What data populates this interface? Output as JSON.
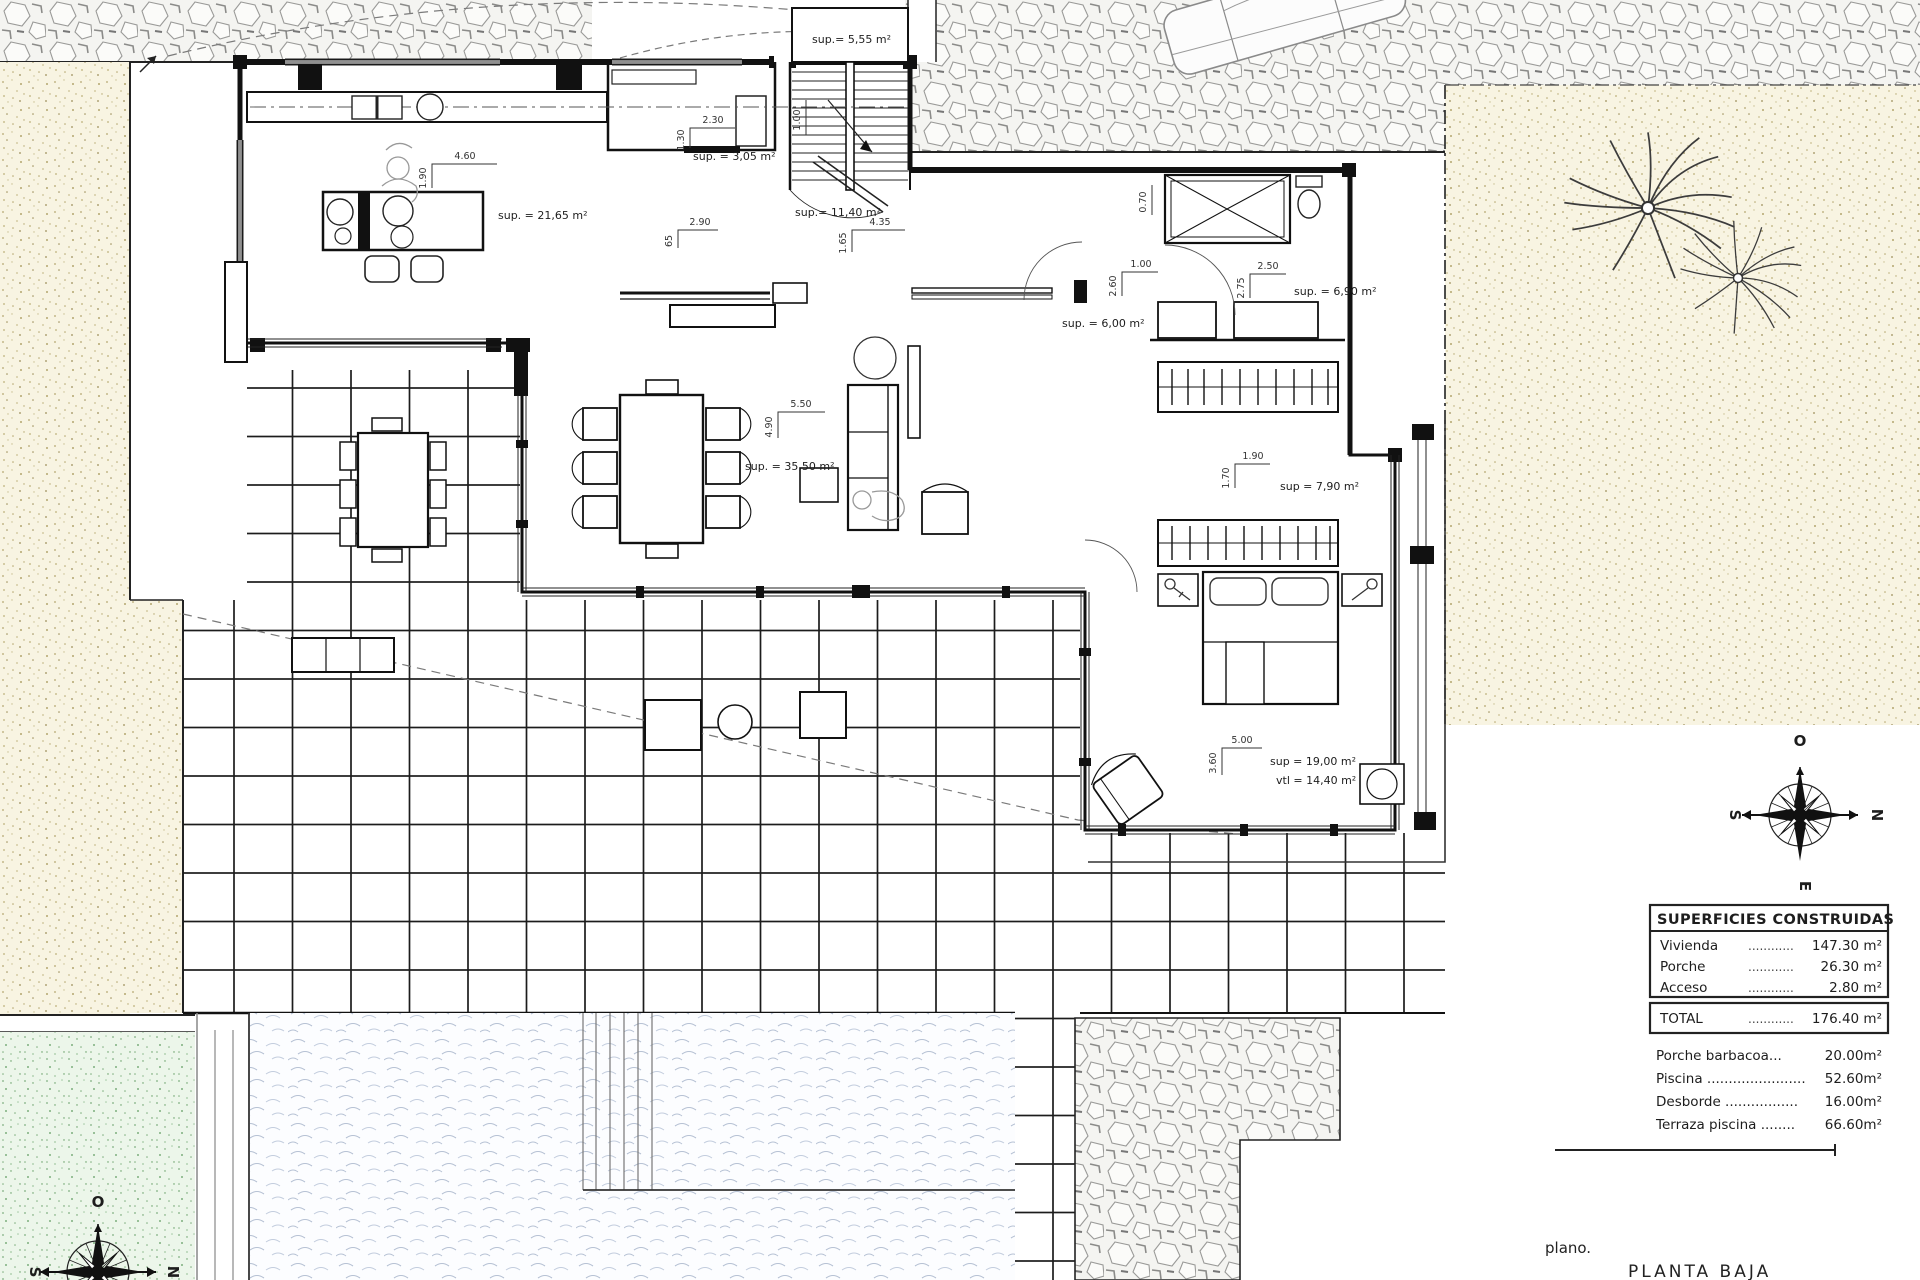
{
  "titles": {
    "plan_label": "plano.",
    "plan_title": "PLANTA BAJA"
  },
  "compass": {
    "top": "O",
    "right": "N",
    "left": "S",
    "bottom": "E"
  },
  "rooms": {
    "stairs": "sup.= 5,55 m²",
    "pantry": "sup. = 3,05 m²",
    "hall": "sup.= 11,40 m²",
    "kitchen": "sup. = 21,65 m²",
    "living": "sup. = 35,50 m²",
    "corridor": "sup. = 6,00 m²",
    "bath": "sup. = 6,90 m²",
    "dressing": "sup = 7,90 m²",
    "bedroom": "sup = 19,00 m²",
    "bedroom_vtl": "vtl = 14,40 m²"
  },
  "dims": {
    "kitchen_w": "4.60",
    "kitchen_h": "1.90",
    "pantry_w": "2.30",
    "pantry_h": "1.30",
    "sideboard_w": "2.90",
    "sideboard_h": "65",
    "hall_w": "4.35",
    "hall_h": "1.65",
    "living_w": "5.50",
    "living_h": "4.90",
    "stair_run": "1.00",
    "corridor_w": "1.00",
    "corridor_h": "2.60",
    "patio_d": "0.70",
    "bath_w": "2.50",
    "bath_h": "2.75",
    "dressing_w": "1.90",
    "dressing_h": "1.70",
    "bedroom_w": "5.00",
    "bedroom_h": "3.60"
  },
  "areas_table": {
    "title": "SUPERFICIES CONSTRUIDAS",
    "rows": [
      {
        "label": "Vivienda",
        "dots": "............",
        "value": "147.30 m²"
      },
      {
        "label": "Porche",
        "dots": "............",
        "value": "26.30 m²"
      },
      {
        "label": "Acceso",
        "dots": "............",
        "value": "2.80 m²"
      }
    ],
    "total": {
      "label": "TOTAL",
      "dots": "............",
      "value": "176.40 m²"
    },
    "extras": [
      {
        "label": "Porche barbacoa...",
        "value": "20.00m²"
      },
      {
        "label": "Piscina .......................",
        "value": "52.60m²"
      },
      {
        "label": "Desborde .................",
        "value": "16.00m²"
      },
      {
        "label": "Terraza piscina ........",
        "value": "66.60m²"
      }
    ]
  }
}
